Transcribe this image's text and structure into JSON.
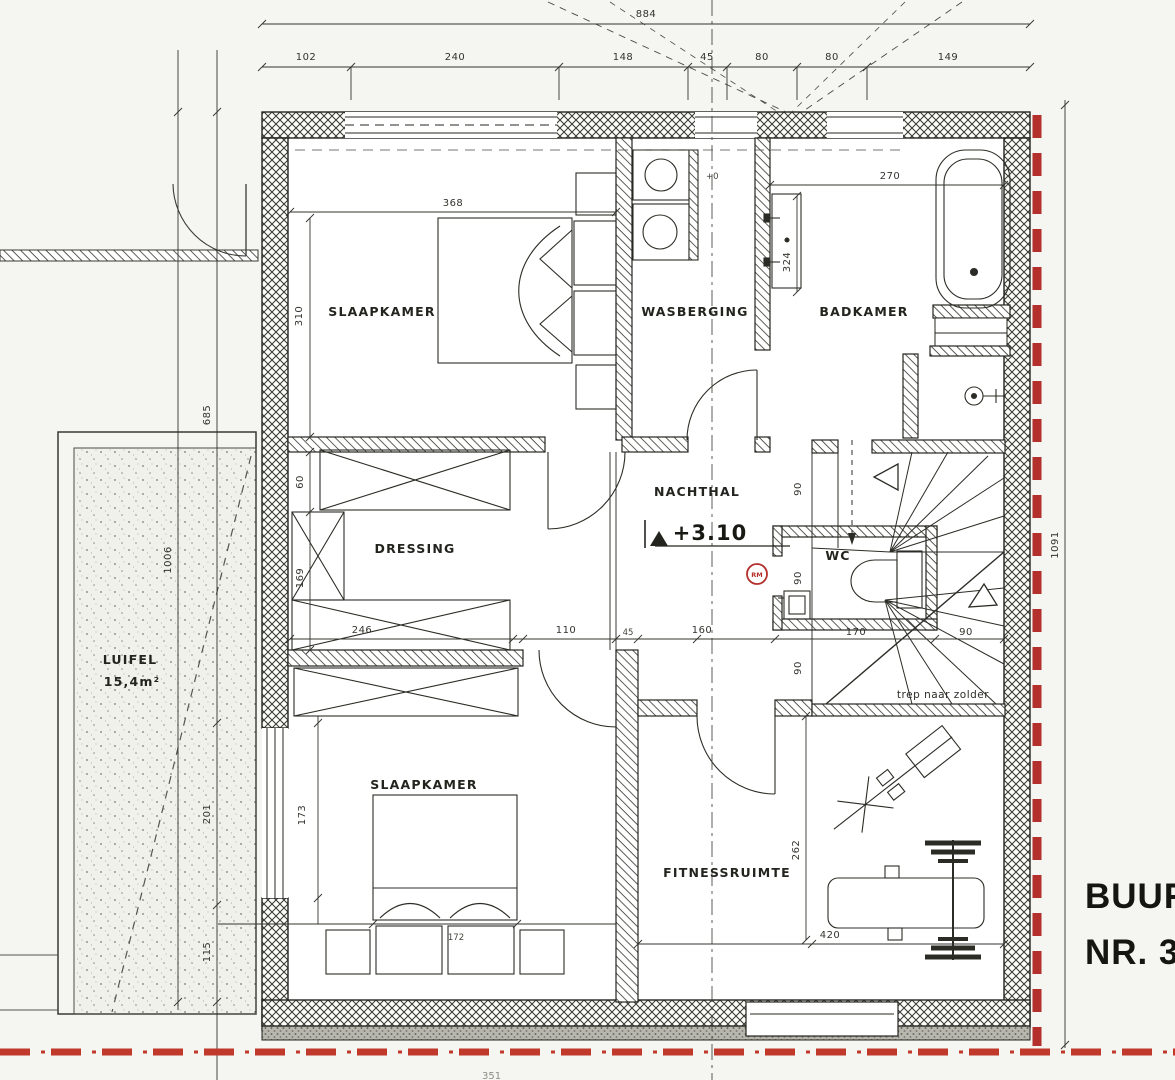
{
  "rooms": {
    "slaapkamer": "SLAAPKAMER",
    "wasberging": "WASBERGING",
    "badkamer": "BADKAMER",
    "dressing": "DRESSING",
    "nachthal": "NACHTHAL",
    "wc": "WC",
    "fitnessruimte": "FITNESSRUIMTE",
    "luifel": "LUIFEL",
    "luifel_area": "15,4m²"
  },
  "annotations": {
    "level": "+3.10",
    "level_zero": "+0",
    "stairs_note": "trep naar zolder",
    "neighbor_line1": "BUUR",
    "neighbor_line2": "NR. 32",
    "smoke_detector": "RM",
    "partial_bottom": "351"
  },
  "dims": {
    "top_total": "884",
    "d102": "102",
    "d240": "240",
    "d148": "148",
    "d45a": "45",
    "d80a": "80",
    "d80b": "80",
    "d149": "149",
    "d368": "368",
    "d310": "310",
    "d270": "270",
    "d324": "324",
    "d60": "60",
    "d169": "169",
    "d246": "246",
    "d110": "110",
    "d45b": "45",
    "d160": "160",
    "d170": "170",
    "d90a": "90",
    "d90b": "90",
    "d90c": "90",
    "d90d": "90",
    "d1006": "1006",
    "d685": "685",
    "d201": "201",
    "d115": "115",
    "d1091": "1091",
    "d173": "173",
    "d172": "172",
    "d262": "262",
    "d420": "420"
  },
  "colors": {
    "ink": "#24241f",
    "red_boundary": "#b3302c",
    "paper": "#f5f5f1"
  }
}
